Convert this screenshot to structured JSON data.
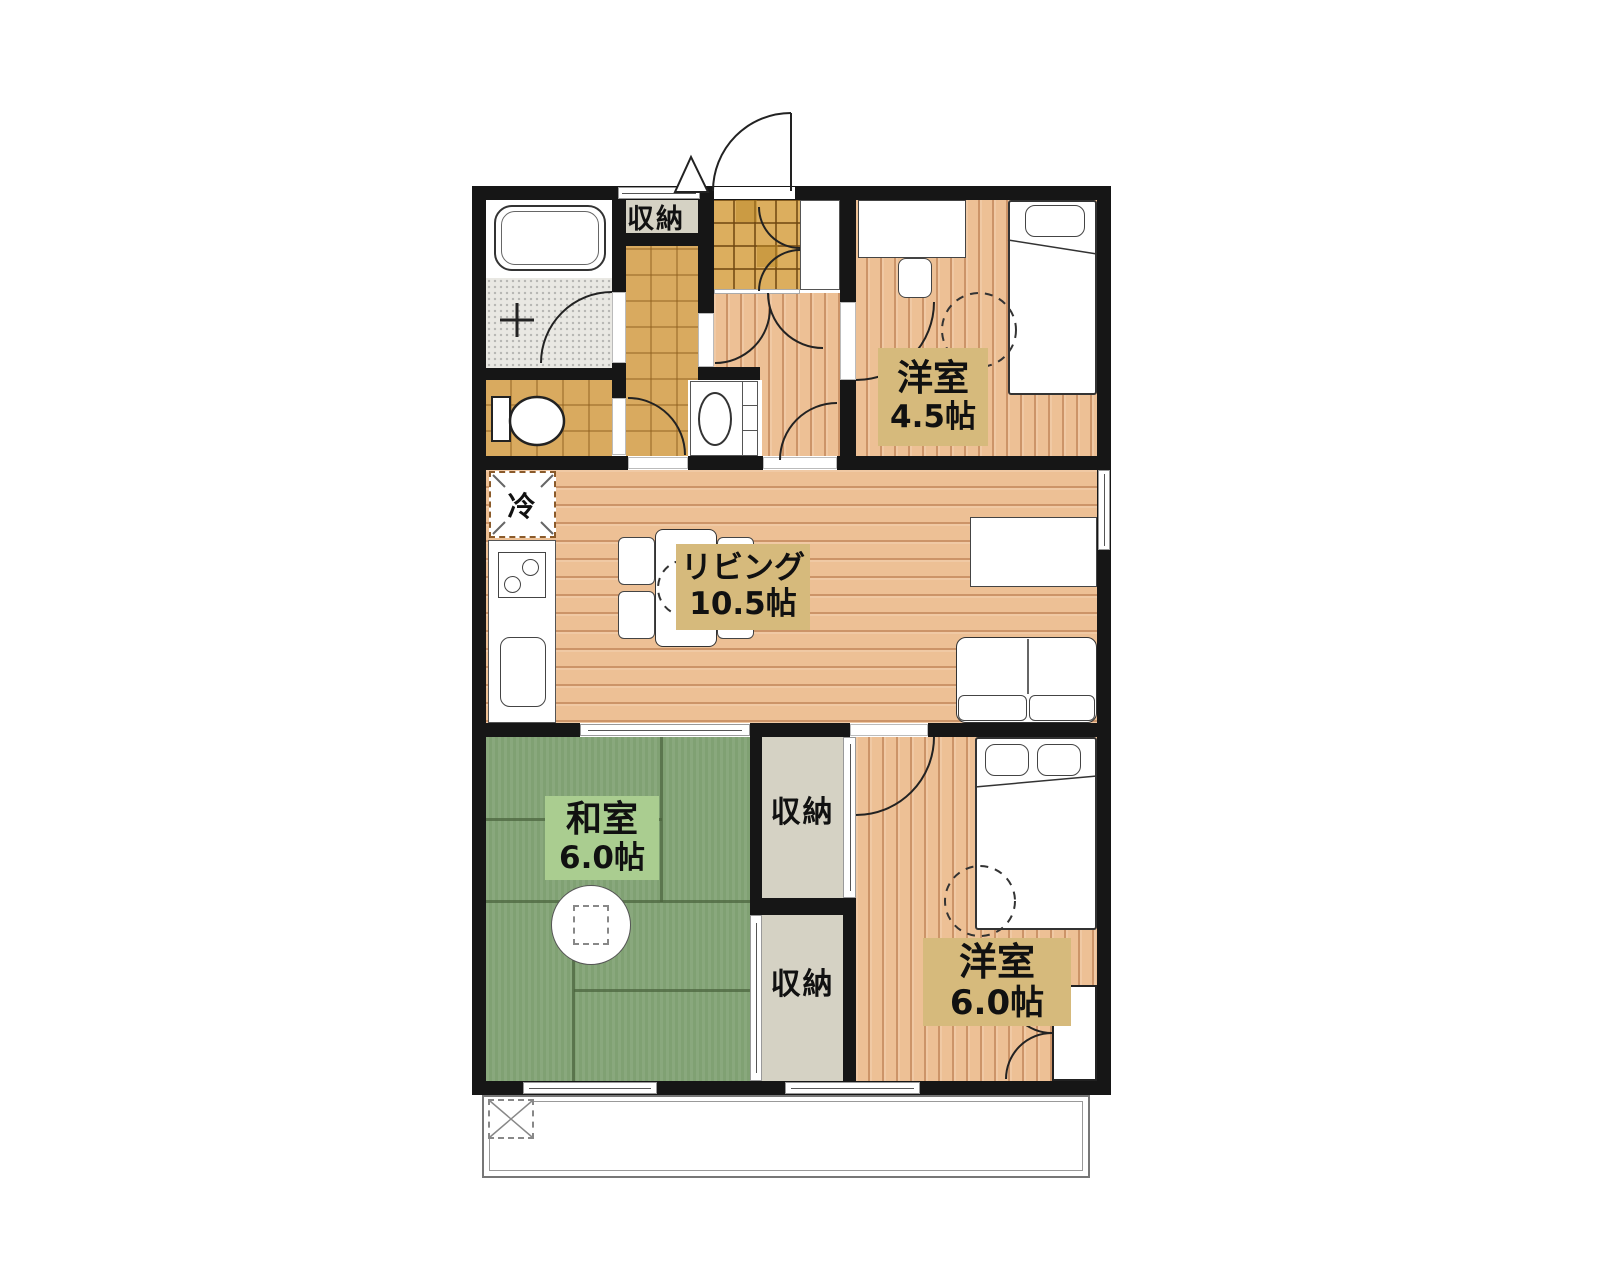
{
  "plan": {
    "rooms": {
      "living": {
        "name": "リビング",
        "size": "10.5帖"
      },
      "western45": {
        "name": "洋室",
        "size": "4.5帖"
      },
      "japanese60": {
        "name": "和室",
        "size": "6.0帖"
      },
      "western60": {
        "name": "洋室",
        "size": "6.0帖"
      }
    },
    "storages": {
      "entry": "収納",
      "upper": "収納",
      "lower": "収納"
    },
    "refrigerator": "冷",
    "colors": {
      "wall": "#161616",
      "wood": "#edc095",
      "wood_line": "#d8a377",
      "tatami": "#80a173",
      "tatami_line": "#4c663f",
      "label_tan": "#d6ba7c",
      "label_green": "#aacd90",
      "closet": "#d5d2c4",
      "tile": "#dcae5e",
      "parquet": "#d9aa5f"
    }
  }
}
